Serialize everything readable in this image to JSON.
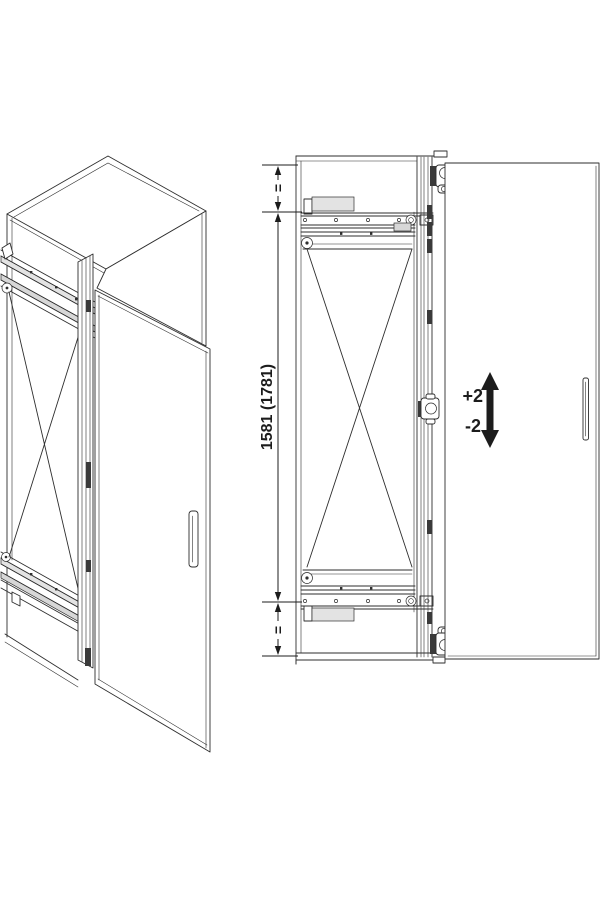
{
  "diagram": {
    "kind": "technical-drawing",
    "subject": "tall cabinet with pivot-sliding door fitting, isometric view and front elevation",
    "dimensions": {
      "height_label": "1581 (1781)",
      "top_margin_label": "=",
      "bottom_margin_label": "=",
      "adjustment_plus": "+2",
      "adjustment_minus": "-2"
    },
    "colors": {
      "line": "#2e2e2e",
      "light_fill": "#e3e3e3",
      "mid_fill": "#d7d7d7",
      "dark_fill": "#1c1c1c",
      "background": "#ffffff"
    }
  }
}
